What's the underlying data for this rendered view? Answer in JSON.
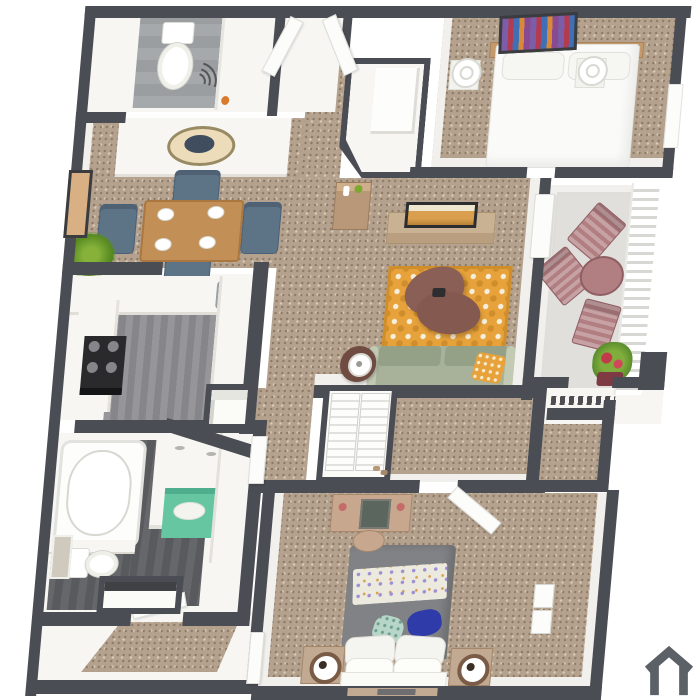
{
  "title": "3D apartment floor plan rendering, two bedroom / two bath with balcony",
  "palette": {
    "wall": "#4a4d53",
    "carpet": "#b4a28e",
    "carpet-dark": "#8c7a66",
    "carpet-light": "#d9cbb5",
    "white": "#f7f6f3",
    "wood": "#c28f57",
    "chair-blue": "#5d7386",
    "sofa": "#a8b29a",
    "sofa-back": "#95a186",
    "rug": "#e7a23b",
    "coffee-table": "#8a5f55",
    "balcony-chair": "#b17e82",
    "balcony-floor": "#e0dfdb",
    "bed-gray": "#808285",
    "pillow-blue": "#2f3ba8",
    "teal": "#66c6a2",
    "tv-wood": "#c9b193",
    "plank": "#95959a",
    "plank-dark": "#66676b",
    "tile": "#a6a9ab",
    "plant": "#7ba82f",
    "logo": "#5b6166"
  },
  "branding": {
    "logo_icon": "house-outline-icon"
  },
  "rooms": [
    {
      "name": "bathroom-1",
      "furniture": [
        "toilet",
        "vanity",
        "shower-curtain"
      ]
    },
    {
      "name": "entry-closet",
      "furniture": [
        "double-doors-open"
      ]
    },
    {
      "name": "foyer-closet",
      "furniture": [
        "angled-walk-in"
      ]
    },
    {
      "name": "bedroom-1",
      "furniture": [
        "bed-white",
        "headboard",
        "lamp-left",
        "lamp-right",
        "wall-art-colorful",
        "window"
      ]
    },
    {
      "name": "dining-area",
      "furniture": [
        "dining-table",
        "four-blue-chairs",
        "place-settings",
        "wall-art",
        "palm-plant",
        "counter-with-decor-oval"
      ]
    },
    {
      "name": "kitchen",
      "furniture": [
        "stove",
        "sink",
        "counters",
        "pantry"
      ]
    },
    {
      "name": "living-room",
      "furniture": [
        "sofa-sage",
        "orange-pillow",
        "area-rug-orange",
        "coffee-table-brown",
        "tv",
        "media-console",
        "side-table-lamp",
        "accent-cabinet"
      ]
    },
    {
      "name": "balcony",
      "furniture": [
        "patio-chair-1",
        "patio-chair-2",
        "patio-chair-3",
        "patio-table",
        "flower-planter",
        "privacy-louver-screen",
        "vent-ledge"
      ]
    },
    {
      "name": "hallway",
      "furniture": [
        "linen-closet-louver-doors"
      ]
    },
    {
      "name": "walk-in-closet",
      "furniture": []
    },
    {
      "name": "bathroom-2",
      "furniture": [
        "bathtub",
        "double-vanity",
        "teal-cabinet",
        "toilet",
        "toilet-room"
      ]
    },
    {
      "name": "bedroom-2",
      "furniture": [
        "bed-gray",
        "patterned-blanket",
        "blue-pillow",
        "teal-pillow",
        "nightstand-left",
        "nightstand-right",
        "vanity-desk",
        "mirror",
        "desk-chair",
        "closet-shelves"
      ]
    },
    {
      "name": "entry-hall",
      "furniture": [
        "coat-closet",
        "carpet-runner"
      ]
    }
  ]
}
